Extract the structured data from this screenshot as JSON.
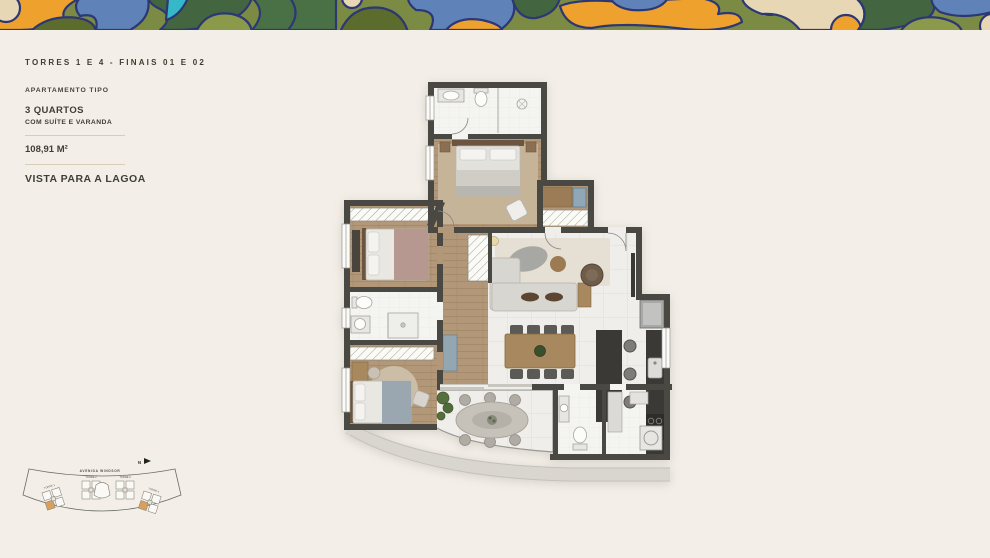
{
  "info": {
    "torres": "TORRES 1 E 4 - FINAIS 01 E 02",
    "apartment_type": "APARTAMENTO TIPO",
    "bedrooms": "3 QUARTOS",
    "suite_note": "COM SUÍTE E VARANDA",
    "area": "108,91 M²",
    "view": "VISTA PARA A LAGOA"
  },
  "key_plan": {
    "street": "AVENIDA WINDSOR",
    "north": "N",
    "towers": [
      {
        "label": "TORRE 1",
        "highlighted_unit": true
      },
      {
        "label": "TORRE 2",
        "highlighted_unit": false
      },
      {
        "label": "TORRE 3",
        "highlighted_unit": false
      },
      {
        "label": "TORRE 4",
        "highlighted_unit": true
      }
    ],
    "highlight_color": "#d9a05c"
  },
  "floor_plan_colors": {
    "wall": "#4a4843",
    "wood_floor": "#b29878",
    "tile_floor": "#f0eeea",
    "bath_floor": "#f4f4f1",
    "rug": "#c6b498",
    "counter": "#3a3936",
    "slab_band": "#d9d6d0"
  },
  "band_colors": {
    "olive": "#7c8b44",
    "orange": "#efa12e",
    "blue": "#5f82b8",
    "dark_green": "#43653f",
    "green": "#4a7046",
    "dark_olive": "#5c6c2c",
    "teal": "#35b9c8",
    "cream": "#e8d7b4",
    "navy_outline": "#2c3776"
  }
}
